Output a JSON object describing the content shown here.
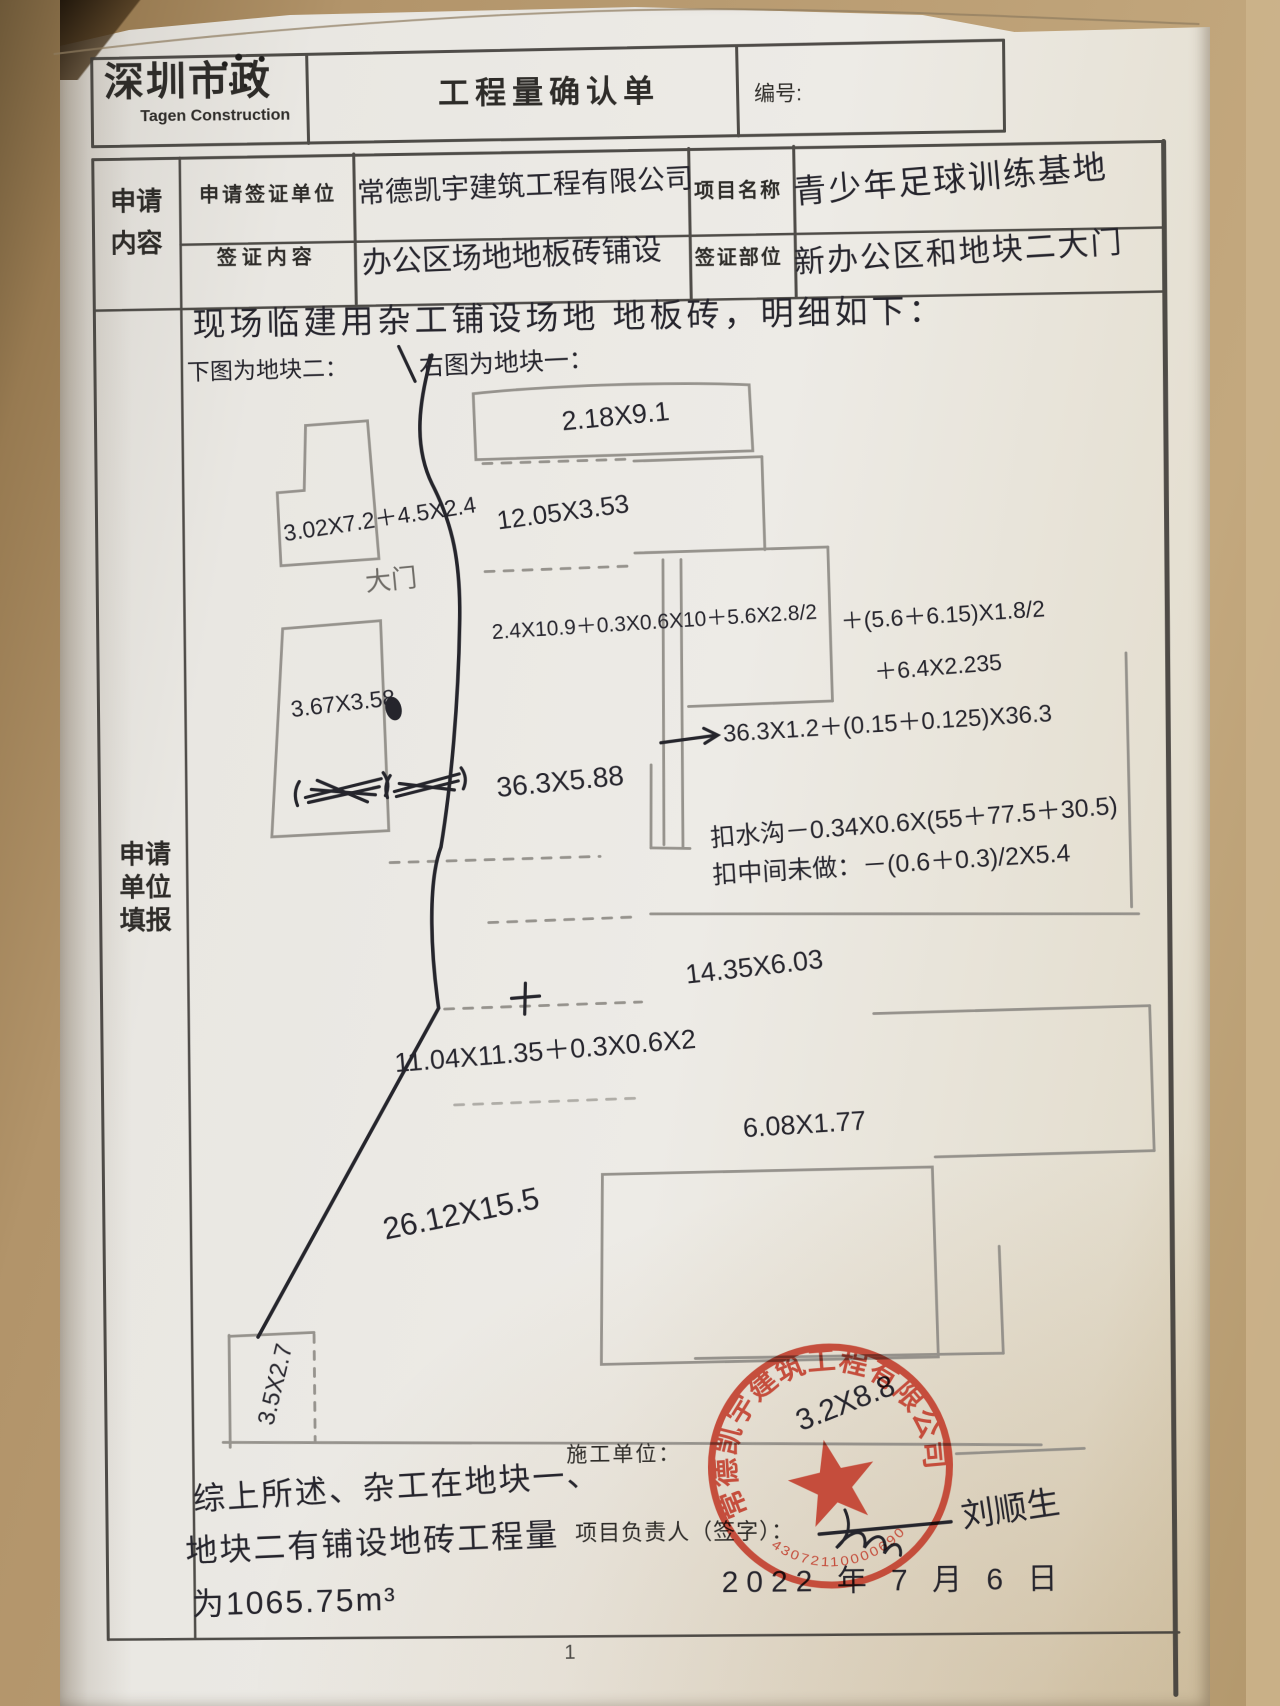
{
  "header": {
    "brand_cn": "深圳市政",
    "brand_en": "Tagen Construction",
    "title": "工程量确认单",
    "doc_no_label": "编号:"
  },
  "left_rail": {
    "top": [
      "申请",
      "内容"
    ],
    "main": [
      "申请",
      "单位",
      "填报"
    ]
  },
  "fields": {
    "apply_unit_label": "申请签证单位",
    "apply_unit_value": "常德凯宇建筑工程有限公司",
    "project_label": "项目名称",
    "project_value": "青少年足球训练基地",
    "visa_content_label": "签证内容",
    "visa_content_value": "办公区场地地板砖铺设",
    "visa_part_label": "签证部位",
    "visa_part_value": "新办公区和地块二大门"
  },
  "body": {
    "intro": "现场临建用杂工铺设场地 地板砖，明细如下：",
    "below_caption": "下图为地块二：",
    "right_caption": "右图为地块一：",
    "gate": "大门"
  },
  "plot2": {
    "m1": "3.02X7.2＋4.5X2.4",
    "m2": "3.67X3.58",
    "m3": "36.3X5.88"
  },
  "plot1": {
    "m_top": "2.18X9.1",
    "m_row2": "12.05X3.53",
    "f1": "2.4X10.9＋0.3X0.6X10＋5.6X2.8/2",
    "f1b": "＋(5.6＋6.15)X1.8/2",
    "f1c": "＋6.4X2.235",
    "f2": "36.3X1.2＋(0.15＋0.125)X36.3",
    "deduct_ditch": "扣水沟－0.34X0.6X(55＋77.5＋30.5)",
    "deduct_mid": "扣中间未做：－(0.6＋0.3)/2X5.4",
    "m_mid": "14.35X6.03",
    "m_mid2": "11.04X11.35＋0.3X0.6X2",
    "m_low": "6.08X1.77",
    "m_big": "26.12X15.5",
    "m_left": "3.5X2.7",
    "seal_note": "3.2X8.8"
  },
  "summary": {
    "line1": "综上所述、杂工在地块一、",
    "line2": "地块二有铺设地砖工程量",
    "line3": "为1065.75m³"
  },
  "footer": {
    "builder_label": "施工单位：",
    "manager_label": "项目负责人（签字）：",
    "signature": "刘顺生",
    "date_text": "2022 年 7 月 6 日",
    "page": "1"
  },
  "seal": {
    "company": "常德凯宇建筑工程有限公司",
    "serial": "43072110000690"
  },
  "colors": {
    "ink": "#26252d",
    "pencil": "#8e8b85",
    "table_line": "#3e3b37",
    "seal_red": "#c2402e",
    "paper": "#e9e7e2",
    "desk": "#b2946a"
  }
}
